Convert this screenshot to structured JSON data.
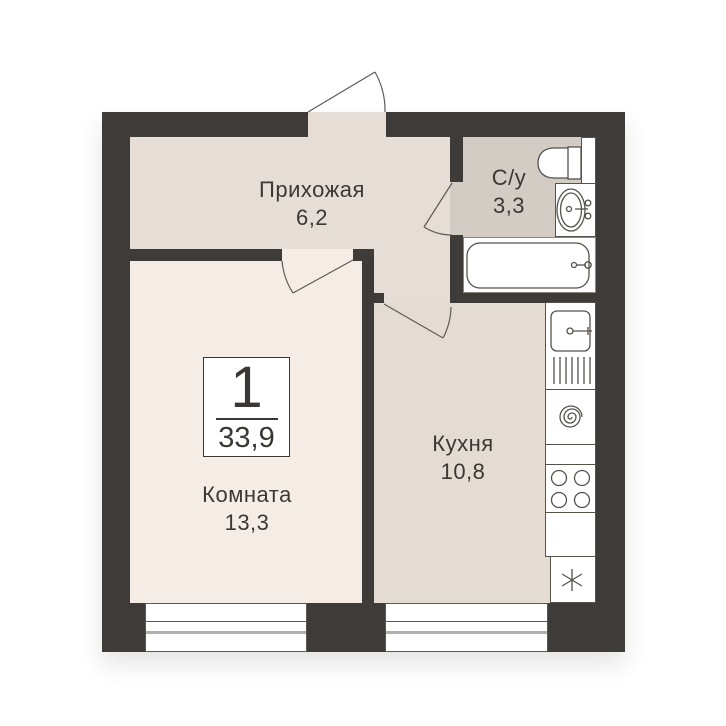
{
  "badge": {
    "rooms_count": "1",
    "total_area": "33,9"
  },
  "rooms": {
    "hallway": {
      "label": "Прихожая",
      "area": "6,2"
    },
    "bathroom": {
      "label": "С/у",
      "area": "3,3"
    },
    "living": {
      "label": "Комната",
      "area": "13,3"
    },
    "kitchen": {
      "label": "Кухня",
      "area": "10,8"
    }
  },
  "colors": {
    "wall": "#3e3b38",
    "hallway_floor": "#e6ded6",
    "living_floor": "#f5ece6",
    "kitchen_floor": "#e4dbd3",
    "bathroom_floor": "#d3ccc5",
    "fixture_line": "#56524c",
    "text": "#3b3834",
    "background": "#ffffff"
  },
  "fixtures": [
    "entrance-door-swing",
    "room-door-swing",
    "bathroom-door-swing",
    "kitchen-door-swing",
    "toilet-icon",
    "bathroom-sink-icon",
    "bathtub-icon",
    "duct-box",
    "kitchen-sink-icon",
    "spiral-appliance-icon",
    "stove-icon",
    "fridge-snowflake-icon",
    "window-living",
    "window-kitchen"
  ]
}
